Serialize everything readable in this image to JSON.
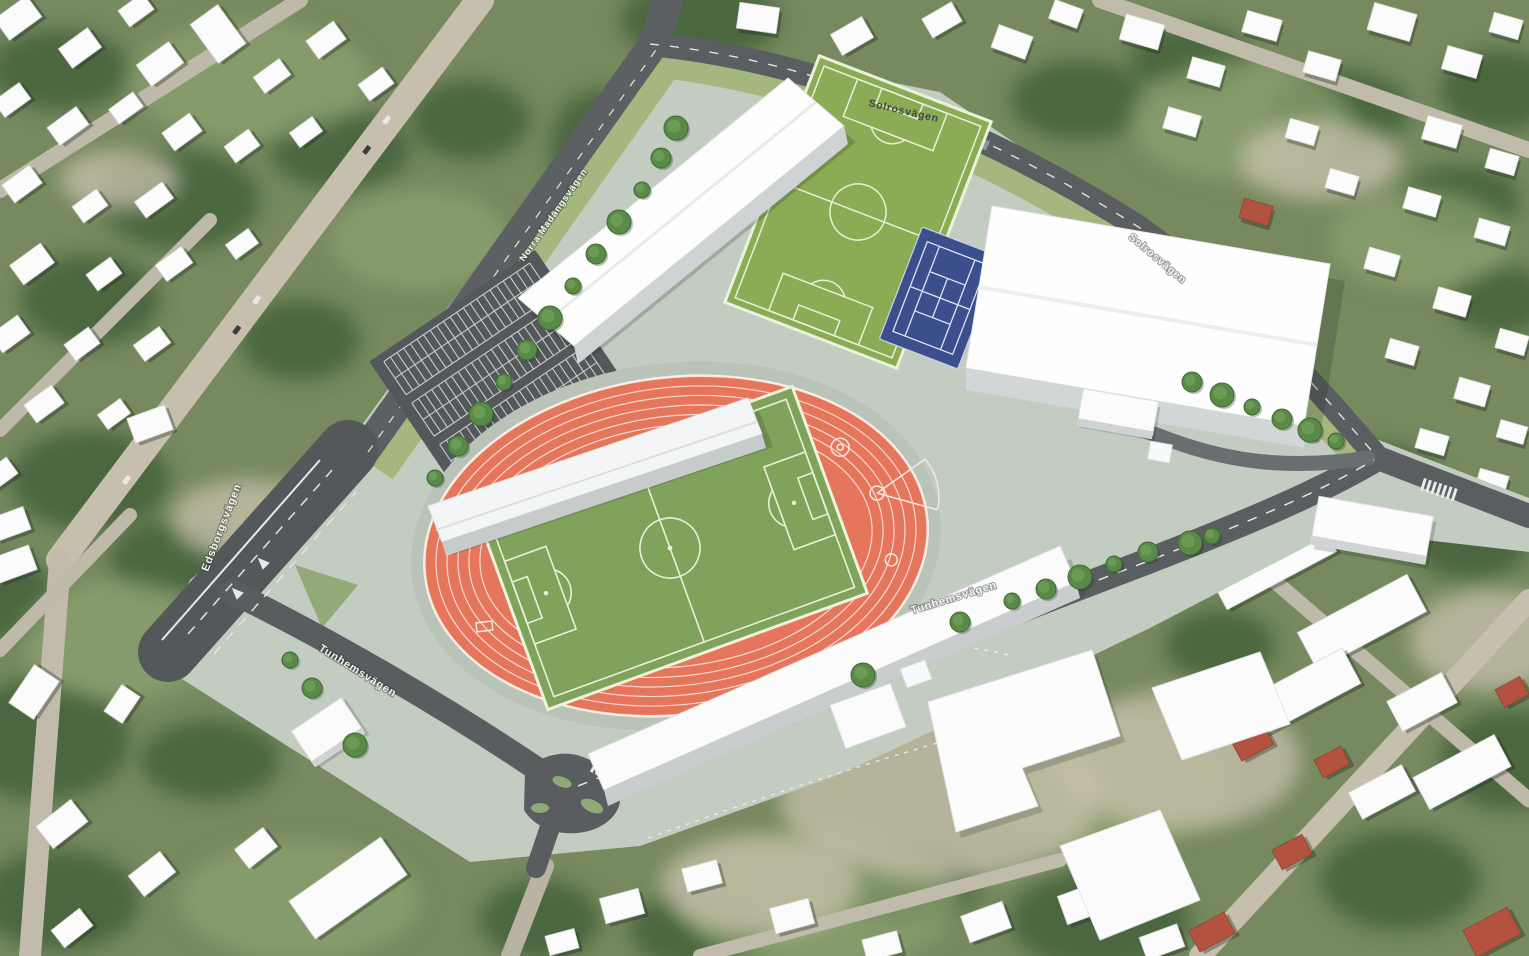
{
  "streets": {
    "solrosvagen_top": "Solrosvägen",
    "solrosvagen_right": "Solrosvägen",
    "norra_madangsvagen": "Norra Madängsvägen",
    "edsborgsvagen": "Edsborgsvägen",
    "tunhemsvagen_west": "Tunhemsvägen",
    "tunhemsvagen_east": "Tunhemsvägen"
  },
  "colors": {
    "plan_surface": "#c2ccc0",
    "athletics_track": "#e5765b",
    "stadium_pitch": "#7fa35a",
    "upper_field": "#8cab55",
    "tennis_court": "#3b4f8c",
    "plan_road": "#5a5e60",
    "building_roof": "#fcfcfd",
    "verge_green": "#a3b77f",
    "aerial_base": "#76895f",
    "background_road": "#c6bfae",
    "red_roof": "#b3523f"
  }
}
